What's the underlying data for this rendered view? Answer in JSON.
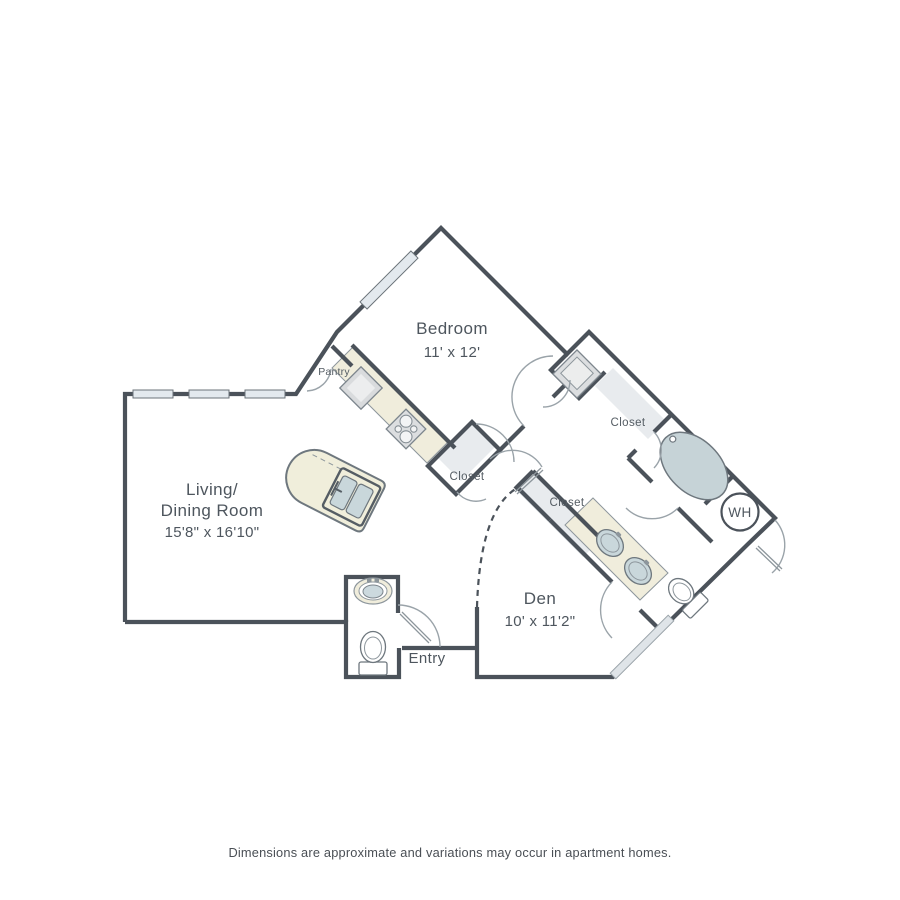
{
  "colors": {
    "wall": "#4b525a",
    "counter_cream": "#f0eddc",
    "fixture_blue": "#ccd9de",
    "closet_floor": "#e8ebee",
    "appliance_gray": "#dcdee0",
    "window_glass": "#e3e9ee",
    "label_text": "#4e565e"
  },
  "rooms": {
    "bedroom": {
      "label": "Bedroom",
      "dims": "11' x 12'"
    },
    "living_dining": {
      "label_line1": "Living/",
      "label_line2": "Dining Room",
      "dims": "15'8\" x 16'10\""
    },
    "den": {
      "label": "Den",
      "dims": "10' x 11'2\""
    },
    "entry": {
      "label": "Entry"
    },
    "pantry": {
      "label": "Pantry"
    },
    "closet_kitchen": {
      "label": "Closet"
    },
    "closet_hall": {
      "label": "Closet"
    },
    "closet_bedroom": {
      "label": "Closet"
    },
    "water_heater": {
      "label": "WH"
    }
  },
  "footer": {
    "disclaimer": "Dimensions are approximate and variations may occur in apartment homes."
  }
}
